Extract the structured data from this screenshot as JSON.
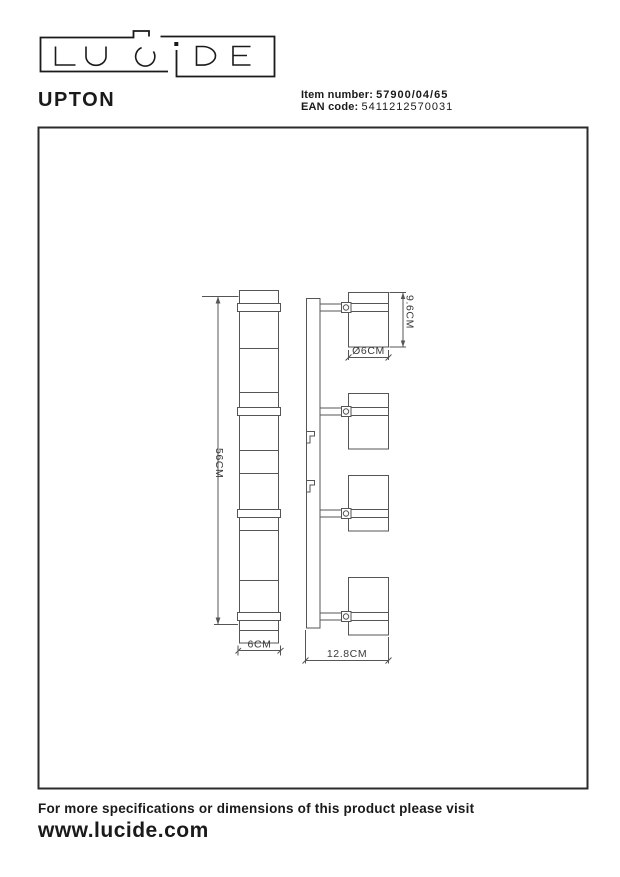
{
  "brand": {
    "name": "LUCIDE"
  },
  "header": {
    "product_name": "UPTON",
    "item_number_label": "Item number:",
    "item_number_value": "57900/04/65",
    "ean_label": "EAN code:",
    "ean_value": "5411212570031"
  },
  "diagram": {
    "dim_bar_length": "56CM",
    "dim_bar_width": "6CM",
    "dim_total_depth": "12.8CM",
    "dim_spot_height": "9.6CM",
    "dim_spot_diameter": "Ø6CM"
  },
  "footer": {
    "note": "For more specifications or dimensions of this product please visit",
    "website": "www.lucide.com"
  }
}
